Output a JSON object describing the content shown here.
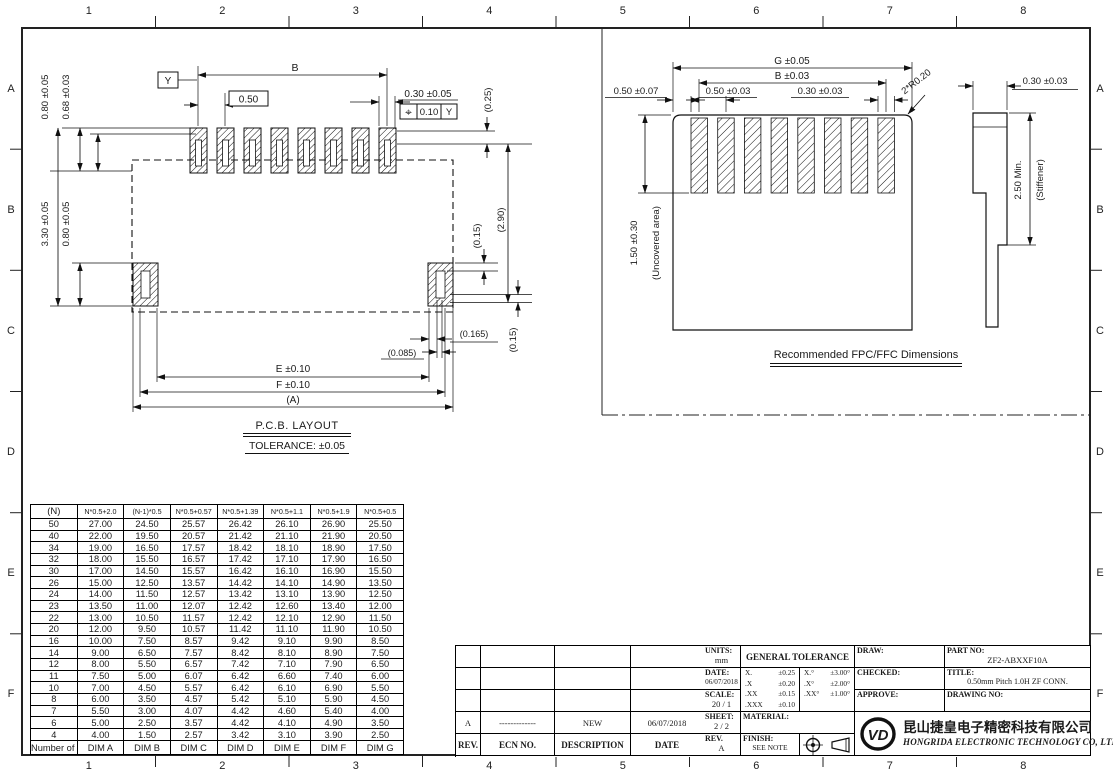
{
  "border": {
    "cols": [
      "1",
      "2",
      "3",
      "4",
      "5",
      "6",
      "7",
      "8"
    ],
    "rows": [
      "A",
      "B",
      "C",
      "D",
      "E",
      "F"
    ]
  },
  "pcb_layout": {
    "title": "P.C.B. LAYOUT",
    "tolerance_note": "TOLERANCE: ±0.05",
    "datum_label": "Y",
    "dim_b": "B",
    "dim_pitch": "0.50",
    "dim_pad_width": "0.30 ±0.05",
    "fcf_symbol": "⌖",
    "fcf_tolerance": "0.10",
    "fcf_datum": "Y",
    "dim_025": "(0.25)",
    "dim_290": "(2.90)",
    "dim_015_right": "(0.15)",
    "dim_080_top": "0.80 ±0.05",
    "dim_068_top": "0.68 ±0.03",
    "dim_330_left": "3.30 ±0.05",
    "dim_080_left": "0.80 ±0.05",
    "dim_0085": "(0.085)",
    "dim_0165": "(0.165)",
    "dim_015_bottom": "(0.15)",
    "dim_e": "E ±0.10",
    "dim_f": "F ±0.10",
    "dim_a": "(A)"
  },
  "fpc_view": {
    "title": "Recommended FPC/FFC Dimensions",
    "dim_g": "G ±0.05",
    "dim_b": "B ±0.03",
    "dim_050_left": "0.50 ±0.07",
    "dim_050_pitch": "0.50 ±0.03",
    "dim_030_finger": "0.30 ±0.03",
    "dim_radius": "2*R0.20",
    "dim_uncovered": "1.50 ±0.30",
    "uncovered_label": "(Uncovered area)",
    "dim_thickness": "0.30 ±0.03",
    "dim_stiffener": "2.50 Min.",
    "stiffener_label": "(Stiffener)"
  },
  "contacts_table": {
    "header": [
      "(N)",
      "N*0.5+2.0",
      "(N-1)*0.5",
      "N*0.5+0.57",
      "N*0.5+1.39",
      "N*0.5+1.1",
      "N*0.5+1.9",
      "N*0.5+0.5"
    ],
    "rows": [
      [
        "50",
        "27.00",
        "24.50",
        "25.57",
        "26.42",
        "26.10",
        "26.90",
        "25.50"
      ],
      [
        "40",
        "22.00",
        "19.50",
        "20.57",
        "21.42",
        "21.10",
        "21.90",
        "20.50"
      ],
      [
        "34",
        "19.00",
        "16.50",
        "17.57",
        "18.42",
        "18.10",
        "18.90",
        "17.50"
      ],
      [
        "32",
        "18.00",
        "15.50",
        "16.57",
        "17.42",
        "17.10",
        "17.90",
        "16.50"
      ],
      [
        "30",
        "17.00",
        "14.50",
        "15.57",
        "16.42",
        "16.10",
        "16.90",
        "15.50"
      ],
      [
        "26",
        "15.00",
        "12.50",
        "13.57",
        "14.42",
        "14.10",
        "14.90",
        "13.50"
      ],
      [
        "24",
        "14.00",
        "11.50",
        "12.57",
        "13.42",
        "13.10",
        "13.90",
        "12.50"
      ],
      [
        "23",
        "13.50",
        "11.00",
        "12.07",
        "12.42",
        "12.60",
        "13.40",
        "12.00"
      ],
      [
        "22",
        "13.00",
        "10.50",
        "11.57",
        "12.42",
        "12.10",
        "12.90",
        "11.50"
      ],
      [
        "20",
        "12.00",
        "9.50",
        "10.57",
        "11.42",
        "11.10",
        "11.90",
        "10.50"
      ],
      [
        "16",
        "10.00",
        "7.50",
        "8.57",
        "9.42",
        "9.10",
        "9.90",
        "8.50"
      ],
      [
        "14",
        "9.00",
        "6.50",
        "7.57",
        "8.42",
        "8.10",
        "8.90",
        "7.50"
      ],
      [
        "12",
        "8.00",
        "5.50",
        "6.57",
        "7.42",
        "7.10",
        "7.90",
        "6.50"
      ],
      [
        "11",
        "7.50",
        "5.00",
        "6.07",
        "6.42",
        "6.60",
        "7.40",
        "6.00"
      ],
      [
        "10",
        "7.00",
        "4.50",
        "5.57",
        "6.42",
        "6.10",
        "6.90",
        "5.50"
      ],
      [
        "8",
        "6.00",
        "3.50",
        "4.57",
        "5.42",
        "5.10",
        "5.90",
        "4.50"
      ],
      [
        "7",
        "5.50",
        "3.00",
        "4.07",
        "4.42",
        "4.60",
        "5.40",
        "4.00"
      ],
      [
        "6",
        "5.00",
        "2.50",
        "3.57",
        "4.42",
        "4.10",
        "4.90",
        "3.50"
      ],
      [
        "4",
        "4.00",
        "1.50",
        "2.57",
        "3.42",
        "3.10",
        "3.90",
        "2.50"
      ]
    ],
    "footer": [
      "Number of Contacts",
      "DIM A",
      "DIM B",
      "DIM C",
      "DIM D",
      "DIM E",
      "DIM F",
      "DIM G"
    ]
  },
  "revision_table": {
    "entry": {
      "rev": "A",
      "ecn": "-------------",
      "description": "NEW",
      "date": "06/07/2018"
    },
    "header": [
      "REV.",
      "ECN NO.",
      "DESCRIPTION",
      "DATE"
    ]
  },
  "title_block": {
    "units_label": "UNITS:",
    "units": "mm",
    "date_label": "DATE:",
    "date": "06/07/2018",
    "scale_label": "SCALE:",
    "scale": "20 / 1",
    "sheet_label": "SHEET:",
    "sheet": "2 / 2",
    "rev_label": "REV.",
    "rev": "A",
    "general_tolerance_label": "GENERAL TOLERANCE",
    "tol_linear": [
      [
        "X.",
        "±0.25"
      ],
      [
        ".X",
        "±0.20"
      ],
      [
        ".XX",
        "±0.15"
      ],
      [
        ".XXX",
        "±0.10"
      ]
    ],
    "tol_angular": [
      [
        "X.°",
        "±3.00°"
      ],
      [
        ".X°",
        "±2.00°"
      ],
      [
        ".XX°",
        "±1.00°"
      ]
    ],
    "material_label": "MATERIAL:",
    "finish_label": "FINISH:",
    "finish": "SEE NOTE",
    "draw_label": "DRAW:",
    "checked_label": "CHECKED:",
    "approve_label": "APPROVE:",
    "part_no_label": "PART NO:",
    "part_no": "ZF2-ABXXF10A",
    "title_label": "TITLE:",
    "title": "0.50mm Pitch 1.0H  ZF  CONN.",
    "drawing_no_label": "DRAWING NO:",
    "logo_monogram": "VD",
    "company_cn": "昆山捷皇电子精密科技有限公司",
    "company_en": "HONGRIDA ELECTRONIC TECHNOLOGY CO, LTD."
  }
}
